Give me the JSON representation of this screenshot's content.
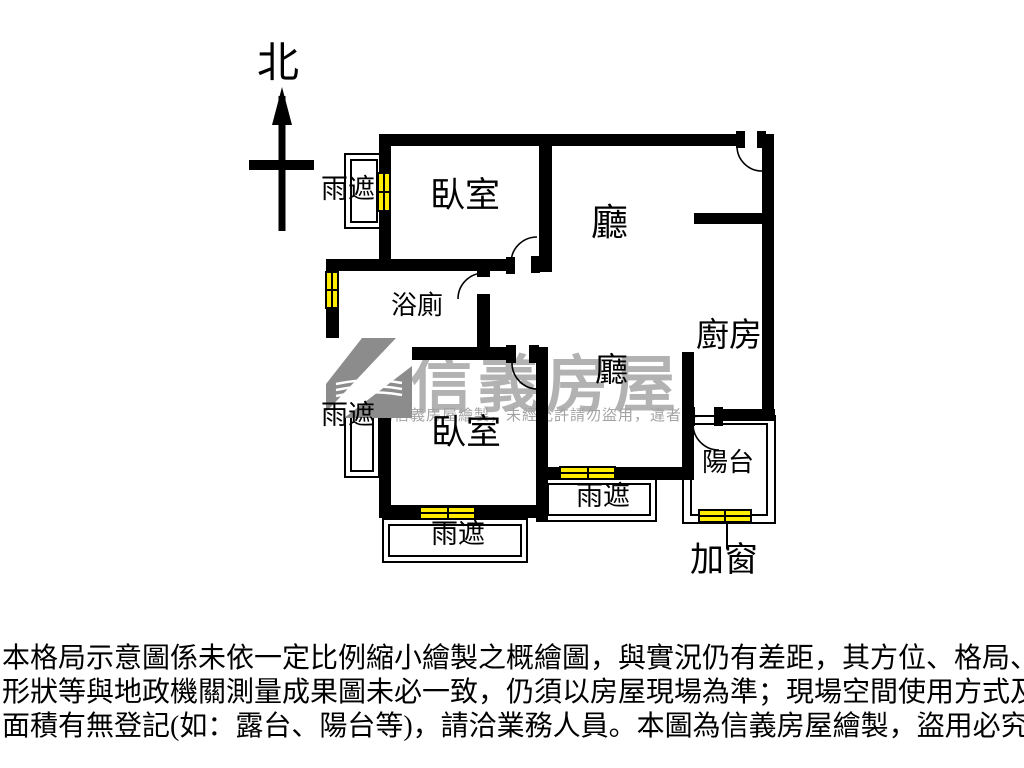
{
  "colors": {
    "background": "#ffffff",
    "wall": "#000000",
    "window_fill": "#ffec00",
    "watermark_brand": "#b2b2b2",
    "watermark_notice": "#a3a3a3",
    "logo_gray": "#8c8c8c"
  },
  "compass": {
    "label": "北"
  },
  "plan": {
    "labels": {
      "bedroom1": "臥室",
      "living": "廳",
      "bathroom": "浴廁",
      "kitchen": "廚房",
      "dining": "廳",
      "bedroom2": "臥室",
      "balcony": "陽台",
      "rain_shelter_1": "雨遮",
      "rain_shelter_2": "雨遮",
      "rain_shelter_3": "雨遮",
      "rain_shelter_4": "雨遮",
      "added_window": "加窗"
    }
  },
  "watermark": {
    "brand": "信義房屋",
    "notice": "為信義房屋繪製，未經允許請勿盜用，違者必",
    "logo": "sinyi-logo"
  },
  "disclaimer": {
    "lines": [
      "本格局示意圖係未依一定比例縮小繪製之概繪圖，與實況仍有差距，其方位、格局、",
      "形狀等與地政機關測量成果圖未必一致，仍須以房屋現場為準；現場空間使用方式及",
      "面積有無登記(如：露台、陽台等)，請洽業務人員。本圖為信義房屋繪製，盜用必究。"
    ]
  }
}
